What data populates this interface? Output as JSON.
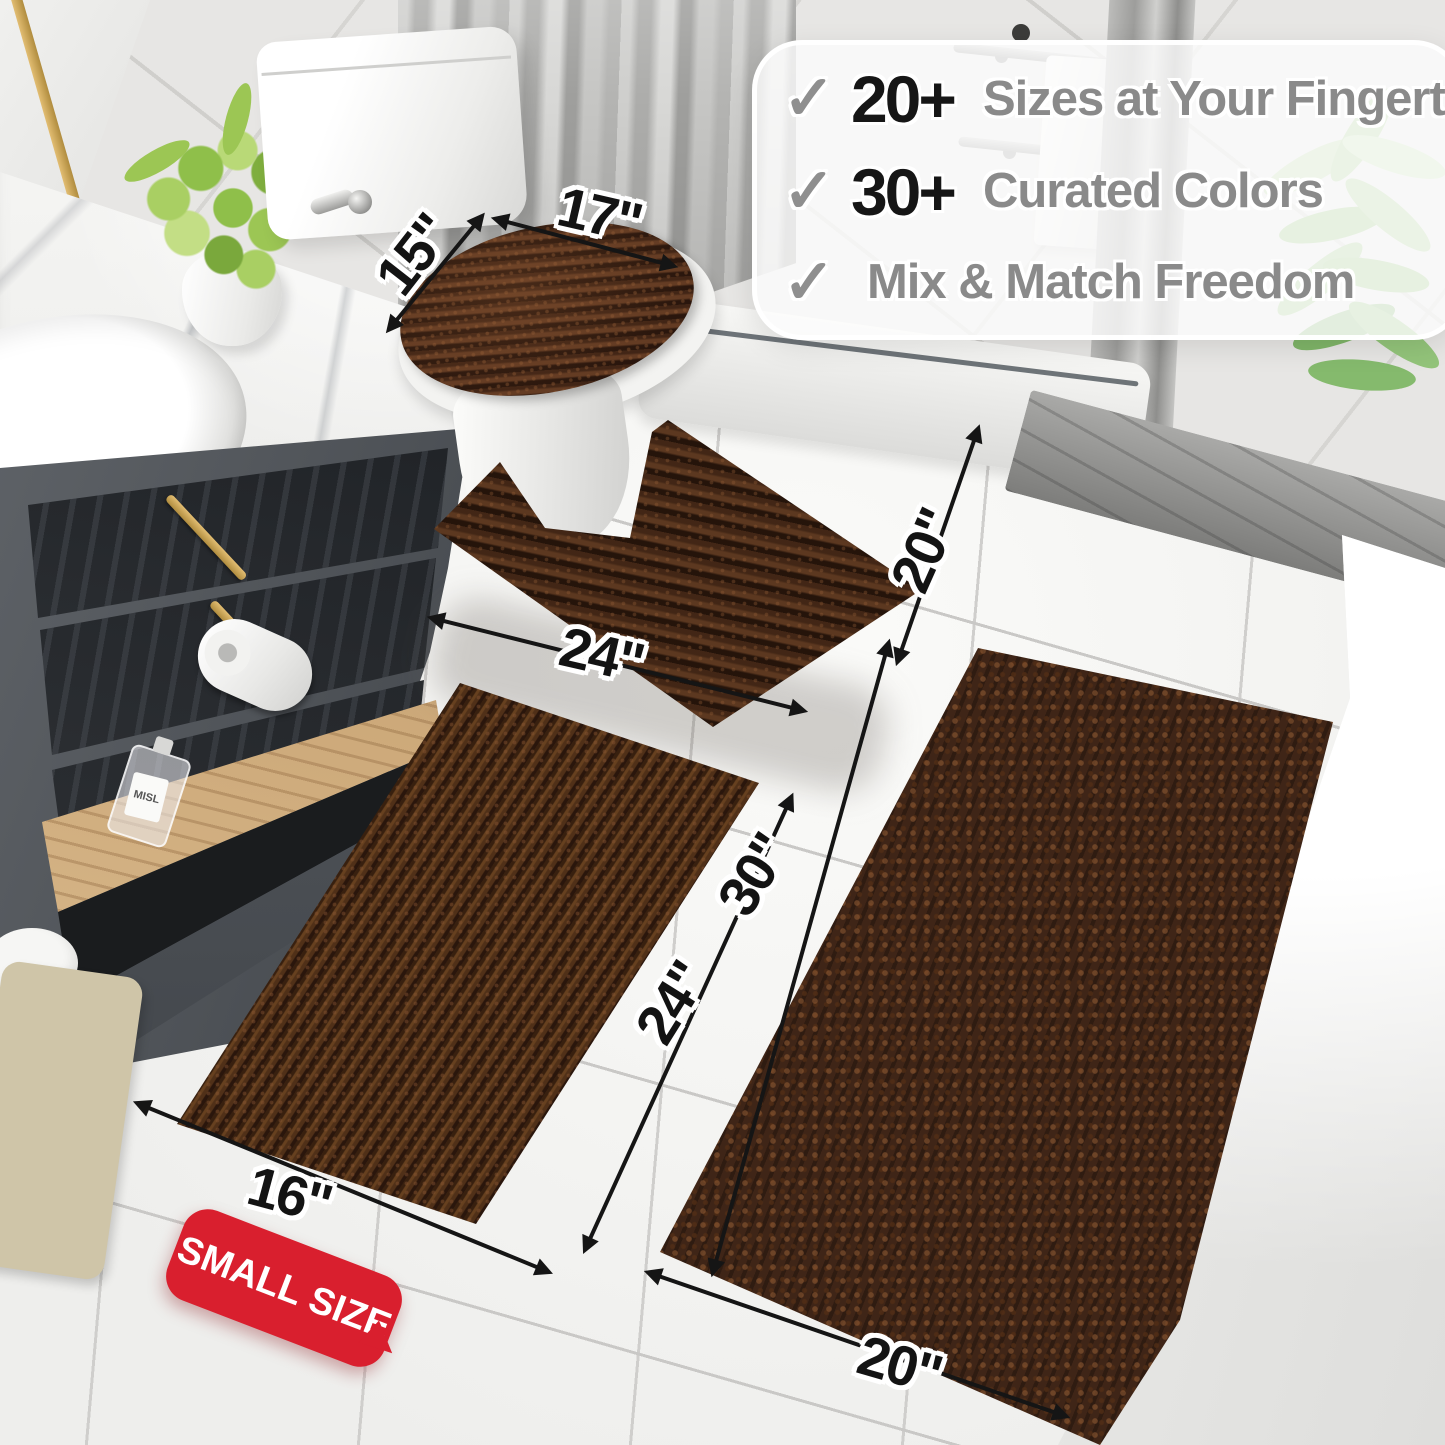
{
  "callout": {
    "items": [
      {
        "check": "✓",
        "stat": "20+",
        "label": "Sizes at Your Fingertips"
      },
      {
        "check": "✓",
        "stat": "30+",
        "label": "Curated Colors"
      },
      {
        "check": "✓",
        "stat": "",
        "label": "Mix & Match Freedom"
      }
    ]
  },
  "dimensions": {
    "lid_depth": "15\"",
    "lid_width": "17\"",
    "contour_depth": "20\"",
    "contour_width": "24\"",
    "small_length": "24\"",
    "small_width": "16\"",
    "large_length": "30\"",
    "large_width": "20\""
  },
  "badge": {
    "label": "SMALL SIZE"
  },
  "vanity": {
    "bottle_label": "MISL"
  },
  "colors": {
    "rug_brown": "#47291a",
    "badge_red": "#d91f2e",
    "stat_black": "#161616",
    "label_gray": "#8a8a8a",
    "gold_accent": "#c9a35a"
  }
}
